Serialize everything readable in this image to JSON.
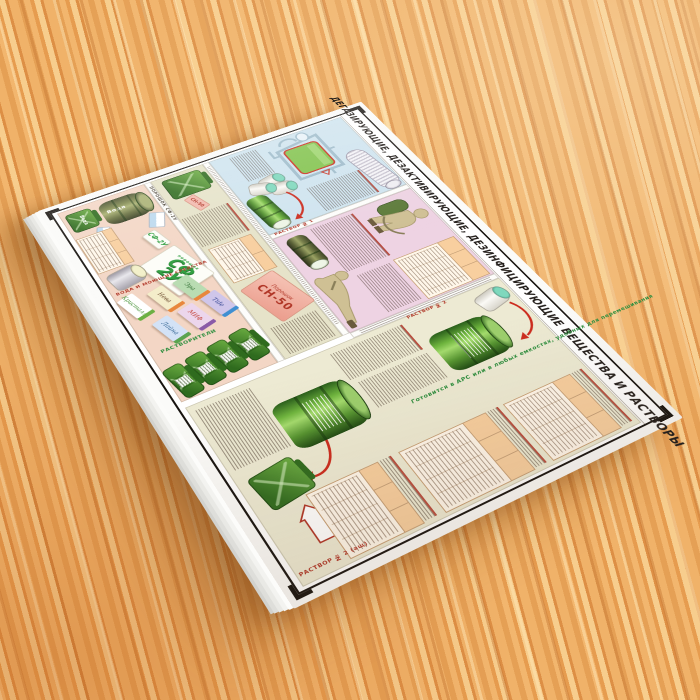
{
  "poster": {
    "title": "ДЕГАЗИРУЮЩИЕ, ДЕЗАКТИВИРУЮЩИЕ, ДЕЗИНФИЦИРУЮЩИЕ ВЕЩЕСТВА И РАСТВОРЫ",
    "sections": {
      "solution1_label": "РАСТВОР № 1",
      "solution2_label": "РАСТВОР № 2",
      "solution2ash_label": "РАСТВОР № 2 (ащ)",
      "prepared_note": "Готовится в АРС или в любых емкостях, удобных для перемешивания",
      "sn50_package_line1": "Порошок",
      "sn50_package_line2": "СН-50",
      "sn50_tag": "СН-50",
      "sf2u_strip": "ПОРОШОК СФ-2У",
      "sf2u_logo_top": "СФ",
      "sf2u_logo_bottom": "2У",
      "sf2u_logo_small": "порошок",
      "sf2u_mini": "СФ-2У",
      "water_barrel_label": "Вода",
      "water_can_label": "Вода",
      "solvents_label": "РАСТВОРИТЕЛИ",
      "water_detergents_label": "ВОДА И МОЮЩИЕ СРЕДСТВА"
    },
    "soaps": [
      {
        "name": "Эра",
        "body": "#b9dcb2",
        "side": "#e8873c",
        "text": "#2e6b2e"
      },
      {
        "name": "Tide",
        "body": "#cfc6ea",
        "side": "#3f8fd2",
        "text": "#2b3f8e"
      },
      {
        "name": "Нева",
        "body": "#f4edca",
        "side": "#e8873c",
        "text": "#6b4a2e"
      },
      {
        "name": "МИФ",
        "body": "#ecd6ec",
        "side": "#8a5aa8",
        "text": "#c0392b"
      },
      {
        "name": "Лайна",
        "body": "#d3e2f6",
        "side": "#5aa44f",
        "text": "#2b5f8e"
      },
      {
        "name": "Кристалл",
        "body": "#ffffff",
        "side": "#6cb043",
        "text": "#3e8e2e"
      }
    ],
    "colors": {
      "section_blue": "#cfe4ef",
      "section_pink": "#eed3e3",
      "section_cream": "#edead3",
      "section_olive": "#e6e3c9",
      "section_salmon": "#f3d6c5",
      "accent_red": "#b03526",
      "accent_green": "#2f8f3f",
      "table_header": "#f8cf9f",
      "barrel_green": "#559430",
      "wood": "#eaa75c"
    }
  }
}
